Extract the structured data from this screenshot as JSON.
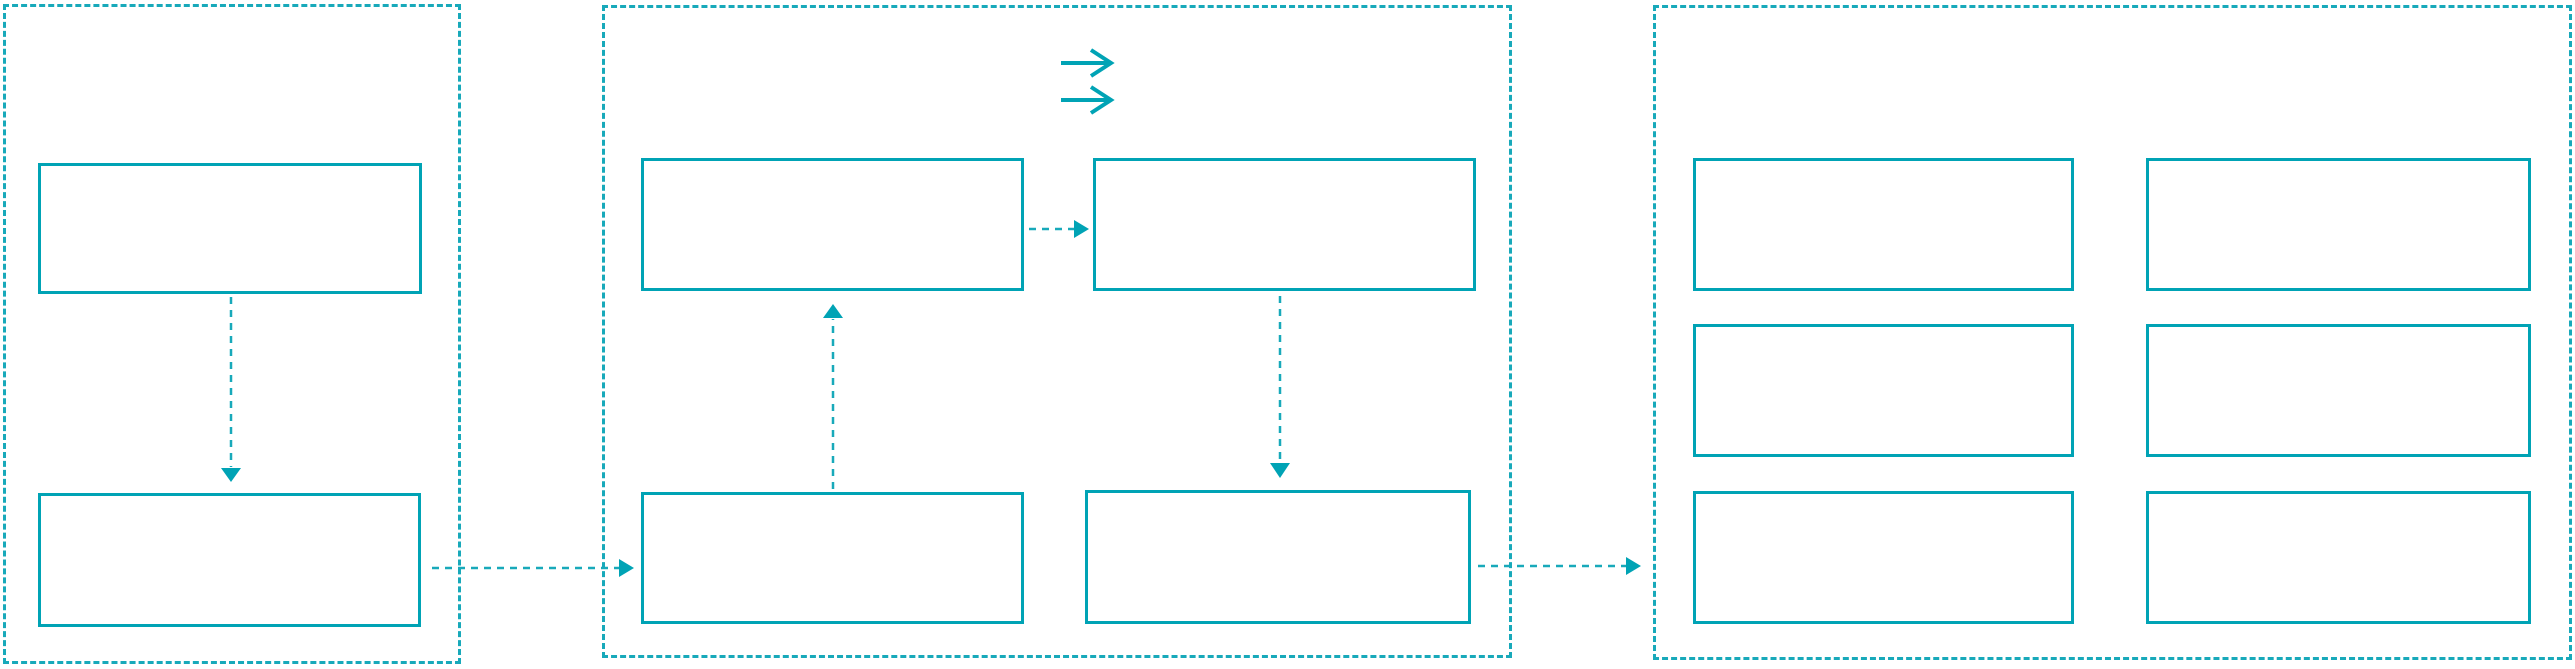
{
  "diagram": {
    "colors": {
      "accent": "#00a3b5",
      "dashed": "#18a9ba",
      "background": "#ffffff"
    },
    "panels": [
      {
        "name": "left-group",
        "boxes": [
          {
            "label": ""
          },
          {
            "label": ""
          }
        ]
      },
      {
        "name": "middle-group",
        "boxes": [
          {
            "label": ""
          },
          {
            "label": ""
          },
          {
            "label": ""
          },
          {
            "label": ""
          }
        ]
      },
      {
        "name": "right-group",
        "boxes": [
          {
            "label": ""
          },
          {
            "label": ""
          },
          {
            "label": ""
          },
          {
            "label": ""
          },
          {
            "label": ""
          },
          {
            "label": ""
          }
        ]
      }
    ],
    "icons": [
      {
        "name": "right-arrow-icon"
      },
      {
        "name": "right-arrow-icon"
      }
    ],
    "connectors": [
      {
        "name": "left-top-to-left-bottom",
        "direction": "down"
      },
      {
        "name": "left-bottom-to-middle-bottom-left",
        "direction": "right"
      },
      {
        "name": "middle-bottom-left-to-middle-top-left",
        "direction": "up"
      },
      {
        "name": "middle-top-left-to-middle-top-right",
        "direction": "right"
      },
      {
        "name": "middle-top-right-to-middle-bottom-right",
        "direction": "down"
      },
      {
        "name": "middle-bottom-right-to-right-group",
        "direction": "right"
      }
    ]
  }
}
